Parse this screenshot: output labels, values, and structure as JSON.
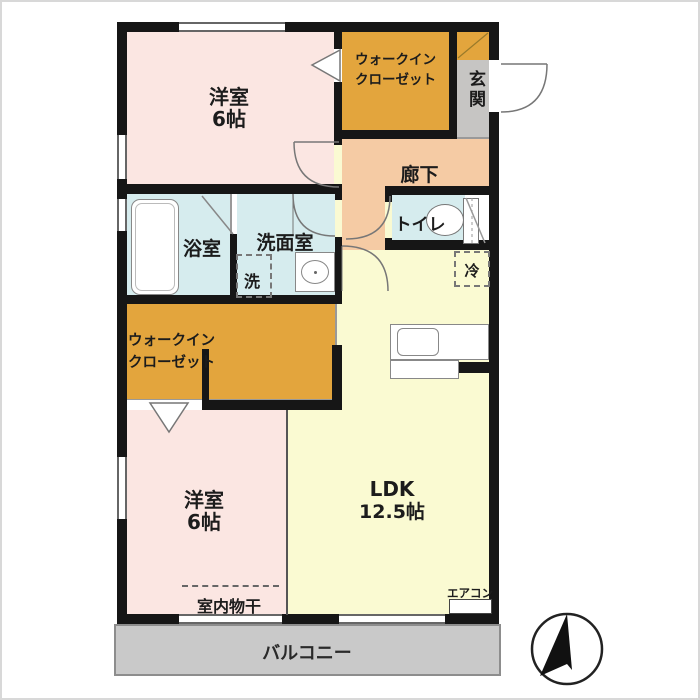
{
  "rooms": {
    "bedroom_top": {
      "label": "洋室",
      "size": "6帖"
    },
    "wic_top": {
      "line1": "ウォークイン",
      "line2": "クローゼット"
    },
    "entrance": {
      "label": "玄関"
    },
    "hallway": {
      "label": "廊下"
    },
    "bathroom": {
      "label": "浴室"
    },
    "washroom": {
      "label": "洗面室"
    },
    "laundry": {
      "label": "洗"
    },
    "toilet": {
      "label": "トイレ"
    },
    "refrigerator": {
      "label": "冷"
    },
    "wic_middle": {
      "line1": "ウォークイン",
      "line2": "クローゼット"
    },
    "bedroom_bottom": {
      "label": "洋室",
      "size": "6帖"
    },
    "ldk": {
      "label": "LDK",
      "size": "12.5帖"
    },
    "aircon": {
      "label": "エアコン"
    },
    "indoor_drying": {
      "label": "室内物干"
    },
    "balcony": {
      "label": "バルコニー"
    }
  },
  "colors": {
    "room_pink": "#fbe6e2",
    "closet_orange": "#e3a53d",
    "hallway_salmon": "#f5cba4",
    "wet_area_blue": "#d6ecee",
    "ldk_yellow": "#fafad2",
    "entrance_gray": "#c6c5c3",
    "balcony_gray": "#c9c9c9",
    "wall_black": "#161616"
  }
}
